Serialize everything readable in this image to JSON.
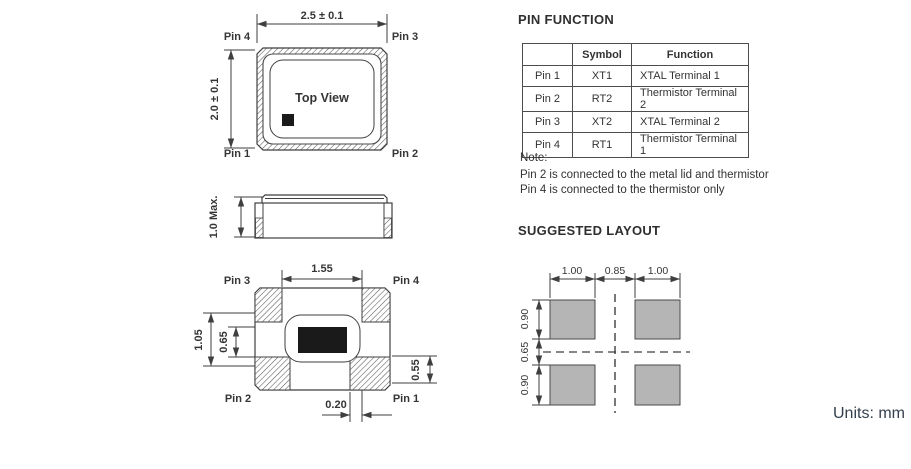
{
  "units_label": "Units: mm",
  "colors": {
    "line": "#3f3f3f",
    "pad_fill": "#b5b5b5",
    "units_text": "#333f4c"
  },
  "top_view": {
    "title": "Top View",
    "dim_width": "2.5 ± 0.1",
    "dim_height": "2.0 ± 0.1",
    "pins": {
      "top_left": "Pin 4",
      "top_right": "Pin 3",
      "bottom_left": "Pin 1",
      "bottom_right": "Pin 2"
    }
  },
  "side_view": {
    "dim_height": "1.0 Max."
  },
  "bottom_view": {
    "dims": {
      "top": "1.55",
      "left_outer": "1.05",
      "left_inner": "0.65",
      "right": "0.55",
      "bottom": "0.20"
    },
    "pins": {
      "top_left": "Pin 3",
      "top_right": "Pin 4",
      "bottom_left": "Pin 2",
      "bottom_right": "Pin 1"
    }
  },
  "pin_function": {
    "heading": "PIN FUNCTION",
    "table": {
      "headers": [
        "",
        "Symbol",
        "Function"
      ],
      "rows": [
        [
          "Pin 1",
          "XT1",
          "XTAL Terminal 1"
        ],
        [
          "Pin 2",
          "RT2",
          "Thermistor Terminal 2"
        ],
        [
          "Pin 3",
          "XT2",
          "XTAL Terminal 2"
        ],
        [
          "Pin 4",
          "RT1",
          "Thermistor Terminal 1"
        ]
      ]
    },
    "note": {
      "label": "Note:",
      "lines": [
        "Pin 2 is connected to the metal lid and thermistor",
        "Pin 4 is connected to the thermistor only"
      ]
    }
  },
  "suggested_layout": {
    "heading": "SUGGESTED LAYOUT",
    "dims": {
      "left_pad": "1.00",
      "gap": "0.85",
      "right_pad": "1.00",
      "top_pad": "0.90",
      "middle_gap": "0.65",
      "bottom_pad": "0.90"
    }
  }
}
